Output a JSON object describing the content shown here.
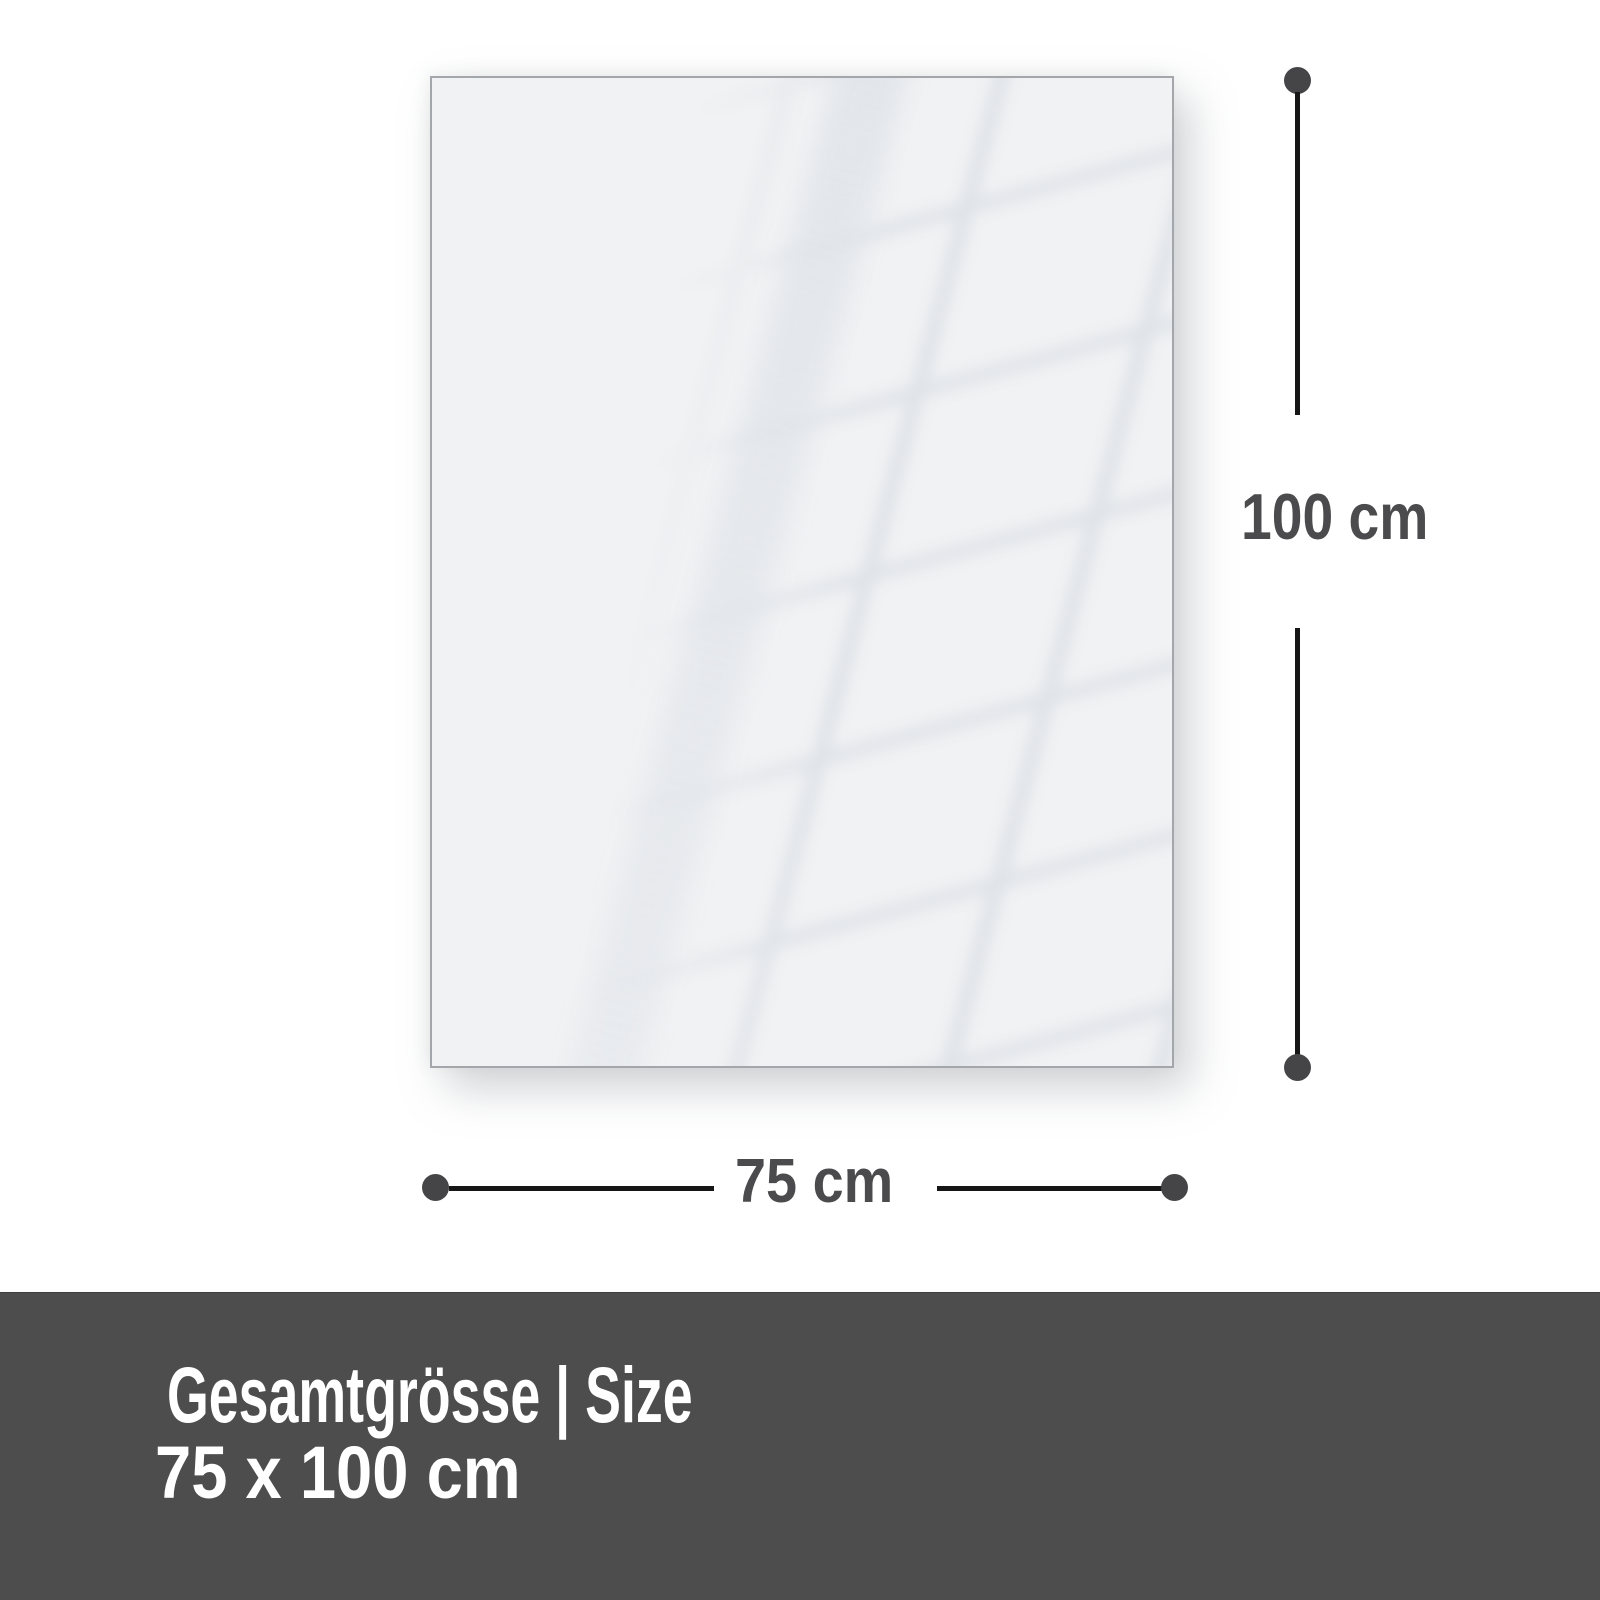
{
  "diagram": {
    "height_label": "100 cm",
    "width_label": "75 cm"
  },
  "footer": {
    "title": "Gesamtgrösse | Size",
    "size_value": "75 x 100 cm"
  },
  "colors": {
    "page_bg": "#ffffff",
    "panel_fill": "#f1f2f4",
    "panel_border": "#a3a6aa",
    "dimension_line": "#161617",
    "dimension_dot": "#454547",
    "dimension_text": "#4b4b4d",
    "footer_bg": "#4d4d4d",
    "footer_text": "#ffffff"
  }
}
